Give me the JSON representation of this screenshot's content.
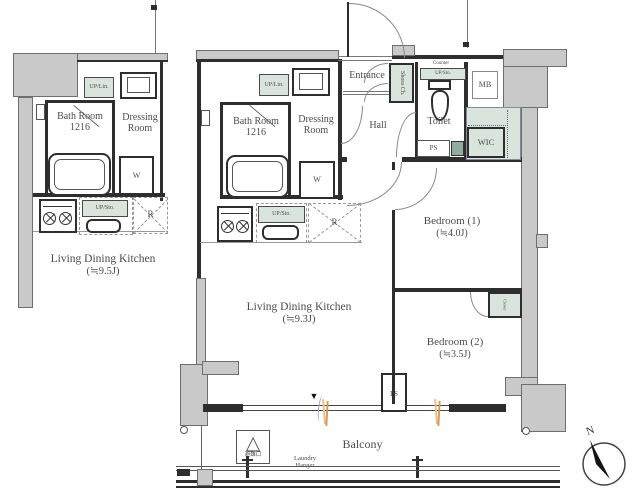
{
  "left_plan": {
    "up_lin": "UP/Lin.",
    "bath_name": "Bath Room",
    "bath_size": "1216",
    "dressing_l1": "Dressing",
    "dressing_l2": "Room",
    "washer": "W",
    "up_sto": "UP/Sto.",
    "fridge": "R",
    "ldk_name": "Living Dining Kitchen",
    "ldk_size": "(≒9.5J)"
  },
  "right_plan": {
    "entrance": "Entrance",
    "shoes": "Shoes Ch.",
    "hall": "Hall",
    "counter": "Counter",
    "toilet_up_sto": "UP/Sto.",
    "toilet": "Toilet",
    "mb": "MB",
    "ps_upper": "PS",
    "wic": "WIC",
    "up_lin": "UP/Lin.",
    "bath_name": "Bath Room",
    "bath_size": "1216",
    "dressing_l1": "Dressing",
    "dressing_l2": "Room",
    "washer": "W",
    "up_sto": "UP/Sto.",
    "fridge": "R",
    "ldk_name": "Living Dining Kitchen",
    "ldk_size": "(≒9.3J)",
    "bedroom1_name": "Bedroom (1)",
    "bedroom1_size": "(≒4.0J)",
    "closet": "Closet",
    "bedroom2_name": "Bedroom (2)",
    "bedroom2_size": "(≒3.5J)",
    "ps_lower": "PS"
  },
  "balcony": {
    "label": "Balcony",
    "laundry_l1": "Laundry",
    "laundry_l2": "Hanger",
    "hatch": "避難口"
  },
  "compass": {
    "north": "N"
  },
  "icons": {
    "hatch_triangle": "△",
    "window_marker": "▼"
  },
  "colors": {
    "wall_gray": "#c9c9c9",
    "fixture_green": "#d9e4dd",
    "line": "#2e2e2e",
    "accent_orange": "#d89a55"
  }
}
